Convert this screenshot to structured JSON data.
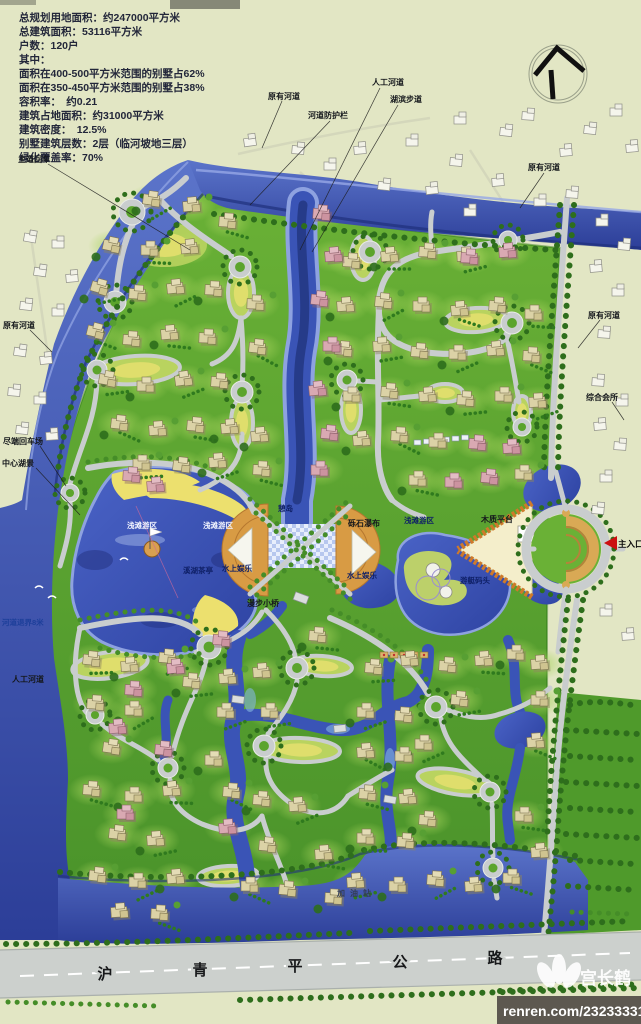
{
  "stats_lines": [
    "总规划用地面积：约247000平方米",
    "总建筑面积：53116平方米",
    "户数：120户",
    "其中：",
    "面积在400-500平方米范围的别墅占62%",
    "面积在350-450平方米范围的别墅占38%",
    "容积率：　约0.21",
    "建筑占地面积：约31000平方米",
    "建筑密度：　12.5%",
    "别墅建筑层数：2层（临河坡地三层）",
    "绿化覆盖率：70%"
  ],
  "labels": [
    {
      "text": "主道回车"
    },
    {
      "text": "原有河道"
    },
    {
      "text": "人工河道"
    },
    {
      "text": "湖滨步道"
    },
    {
      "text": "河道防护栏"
    },
    {
      "text": "原有河道"
    },
    {
      "text": "原有河道"
    },
    {
      "text": "综合会所"
    },
    {
      "text": "原有河道"
    },
    {
      "text": "尽端回车场"
    },
    {
      "text": "中心湖景"
    },
    {
      "text": "河道退界8米"
    },
    {
      "text": "人工河道"
    },
    {
      "text": "浅滩游区"
    },
    {
      "text": "浅滩游区"
    },
    {
      "text": "憩岛"
    },
    {
      "text": "砾石瀑布"
    },
    {
      "text": "溪湖茶亭"
    },
    {
      "text": "水上娱乐"
    },
    {
      "text": "水上娱乐"
    },
    {
      "text": "漫步小桥"
    },
    {
      "text": "浅滩游区"
    },
    {
      "text": "木质平台"
    },
    {
      "text": "游艇码头"
    },
    {
      "text": "主入口"
    },
    {
      "text": "加油站"
    }
  ],
  "highway": {
    "chars": [
      "沪",
      "青",
      "平",
      "公",
      "路"
    ]
  },
  "watermark": {
    "author": "宫长鹤",
    "site": "renren.com/232333316"
  },
  "colors": {
    "paper": "#e2e6c4",
    "site_green": "#5ba42c",
    "river_blue": "#3a54b6",
    "lake_blue": "#3c55c0",
    "road_gray": "#c9cdce",
    "beach_yellow": "#ece06e",
    "plaza_tan": "#d89b44",
    "highway_gray": "#ccd0cd",
    "tree_green": "#2e6e1c",
    "arrow_red": "#cc1010"
  }
}
